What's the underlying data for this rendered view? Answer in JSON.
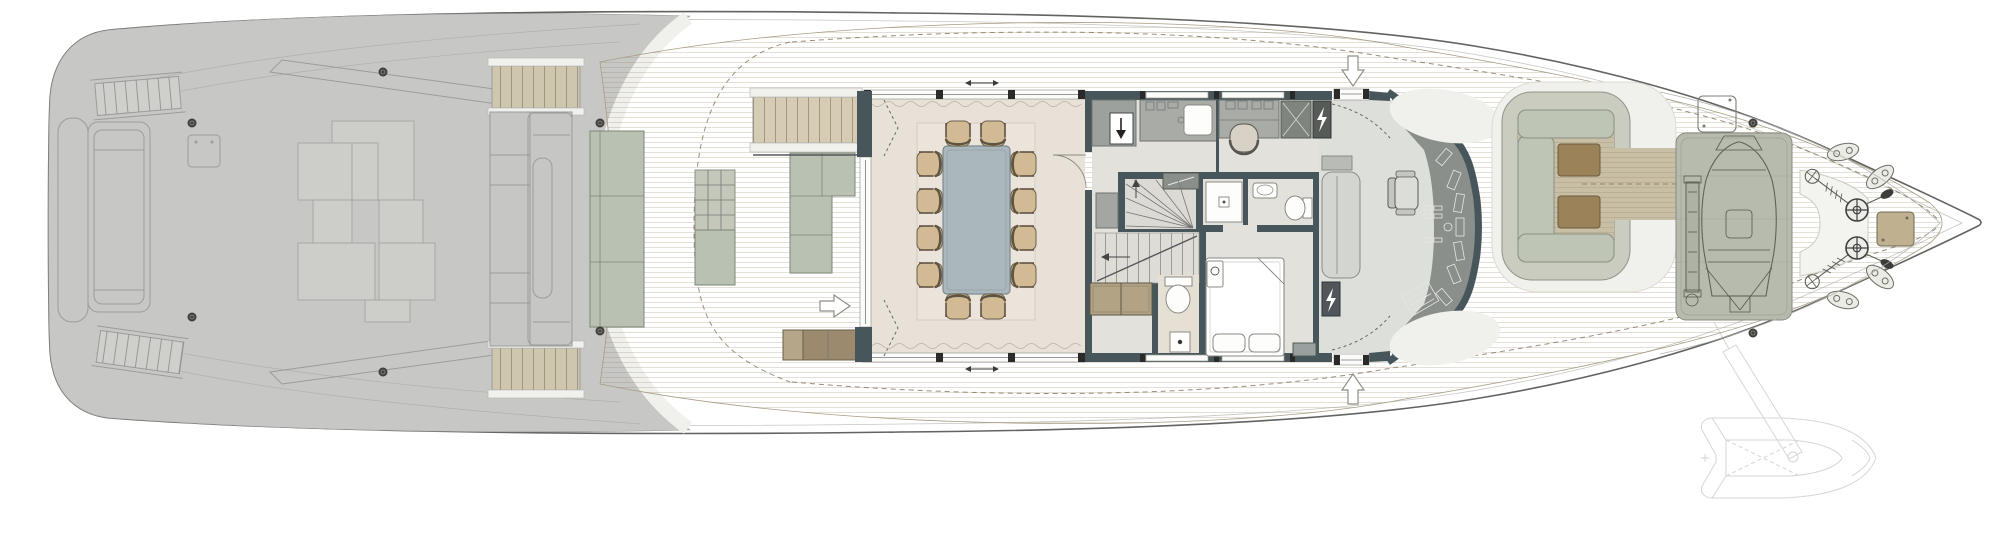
{
  "scene": {
    "subject": "motor yacht main deck floor plan, top view, bow pointing right",
    "visible_text": "none"
  },
  "colors": {
    "background": "#ffffff",
    "hull_fill": "#f0f0ee",
    "hull_stroke": "#636360",
    "inner_line": "#c6c6c0",
    "stern_fill": "#c7c7c6",
    "stern_line": "#9c9c9a",
    "stern_light": "#cfcfcd",
    "teak": "#c8bfa6",
    "plank_line": "#ab9f83",
    "ivory": "#f0f0ed",
    "wall": "#46565a",
    "glass": "#fbfbf9",
    "dining_floor": "#e8e1d8",
    "interior_floor": "#e3e1db",
    "bridge_floor": "#dddfda",
    "console": "#8b8f8b",
    "rug": "#ebe4db",
    "table_top": "#aab7bd",
    "chair_seat": "#d2bb94",
    "chair_back": "#5f5443",
    "sofa": "#b9c1b2",
    "grid_table": "#c3c8ba",
    "bench_wood": "#9b8a6e",
    "stair_wood": "#d5ccb3",
    "counter": "#a8aba6",
    "counter_dark": "#9da19d",
    "appliance": "#80847f",
    "appliance_dark": "#565b57",
    "stool": "#d8d2c6",
    "bed": "#ffffff",
    "cabinet_tan": "#b2a384",
    "bow_seat_ring": "#c9ccbf",
    "bow_cushion": "#bfc5b5",
    "bow_table_wood": "#9b8259",
    "tender_well": "#b7bbad",
    "white_patch": "#f3f3f0",
    "metal_dark": "#3f3f3b",
    "ghost_line": "#d6d6d3",
    "arrow_fill": "#ffffff",
    "arrow_stroke": "#8f8f85"
  },
  "icons": {
    "entry_arrow_top": "arrow-down",
    "entry_arrow_bottom": "arrow-up",
    "walkway_arrow": "arrow-right",
    "stair_down_arrow": "arrow-left",
    "winder_up_arrow": "arrow-up",
    "dumbwaiter_arrow": "arrow-down",
    "electrical_panel": "lightning-bolt",
    "sliding_door_symbol": "double-headed-arrow",
    "door_swing": "quarter-arc",
    "curtain": "wavy-line",
    "windlass": "circle-with-cross",
    "mooring_cleat": "oval-with-two-holes"
  },
  "counts": {
    "dining_chairs": 12,
    "dining_tables": 1,
    "stern_sun_pad_panels": 8,
    "windlasses": 2,
    "foredeck_oval_cleats": 4,
    "deck_cleat_dots": 8,
    "bow_lounge_tables": 2,
    "entry_arrows": 3,
    "sliding_door_arrows": 2,
    "bow_seating_cushions": 3,
    "beds": 1,
    "toilets": 3,
    "showers": 2
  }
}
